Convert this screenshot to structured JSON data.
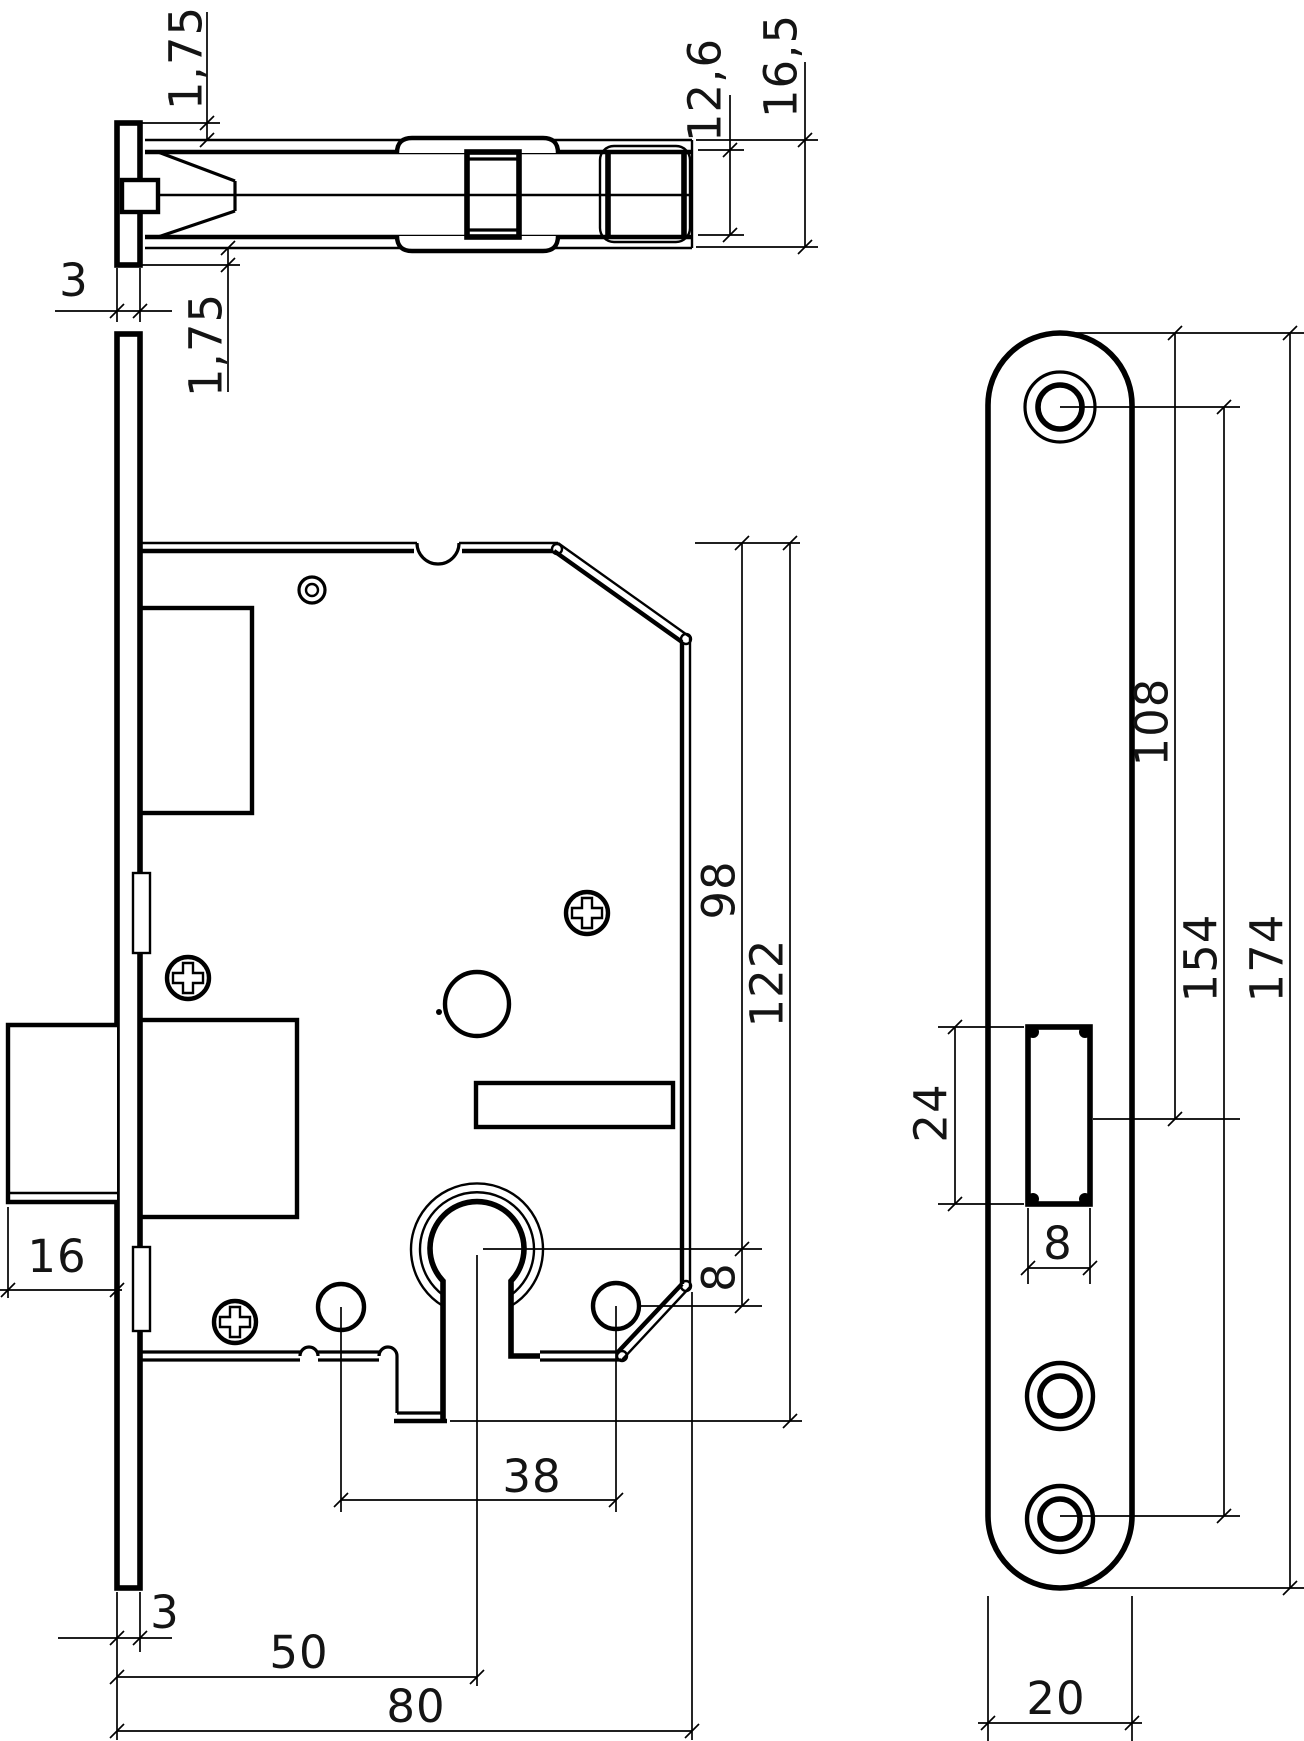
{
  "drawing": {
    "type": "technical-drawing-mortise-door-lock",
    "background": "#ffffff",
    "line_color": "#000000",
    "views": {
      "top_view": {
        "dims": {
          "faceplate_lip_top": "1,75",
          "case_inner_width": "12,6",
          "case_outer_width": "16,5",
          "faceplate_thickness": "3",
          "faceplate_lip_bottom": "1,75"
        }
      },
      "front_view": {
        "dims": {
          "deadbolt_throw": "16",
          "top_to_cylinder_center": "98",
          "body_height_overall": "122",
          "cylinder_to_fix_hole": "8",
          "fix_hole_spacing": "38",
          "faceplate_thickness": "3",
          "backset": "50",
          "body_depth": "80"
        }
      },
      "faceplate_view": {
        "dims": {
          "top_to_cutout_center": "108",
          "screw_hole_spacing": "154",
          "plate_length": "174",
          "cutout_height": "24",
          "cutout_width": "8",
          "plate_width": "20"
        }
      }
    }
  }
}
